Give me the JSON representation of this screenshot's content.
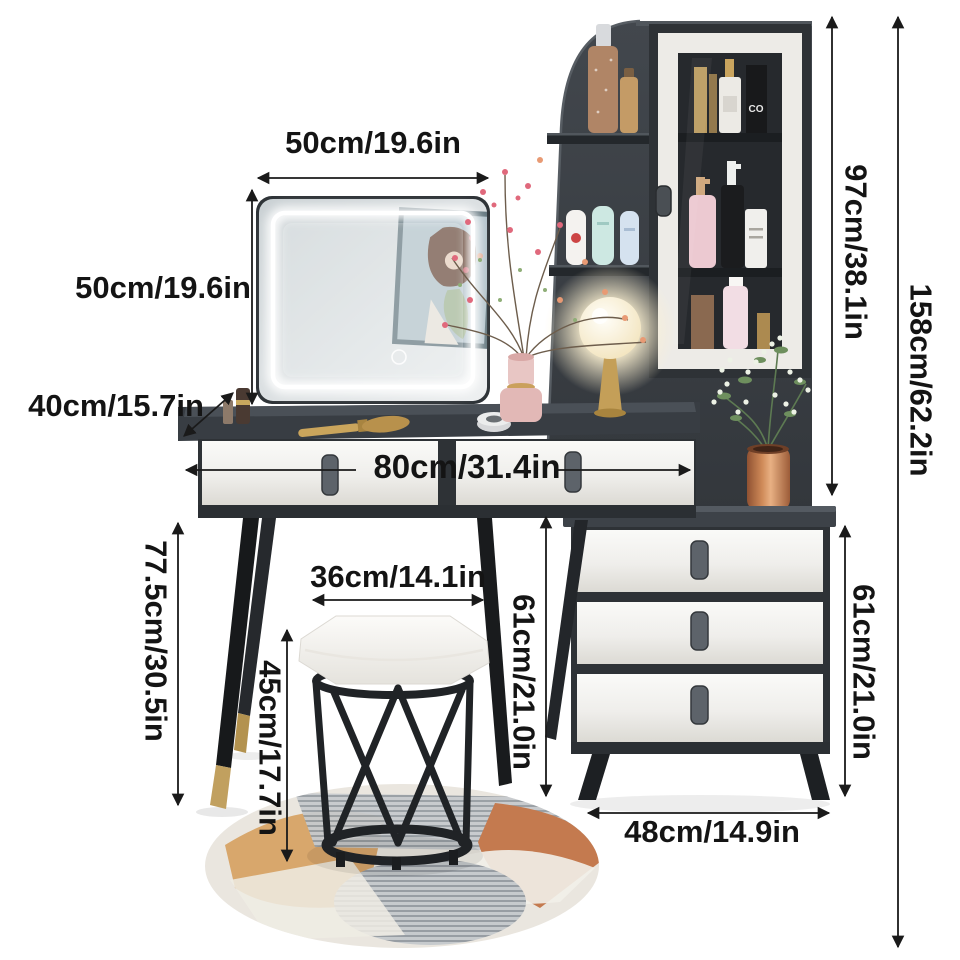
{
  "dims": {
    "mirror_width": "50cm/19.6in",
    "mirror_height": "50cm/19.6in",
    "table_depth": "40cm/15.7in",
    "table_width": "80cm/31.4in",
    "table_height": "77.5cm/30.5in",
    "stool_width": "36cm/14.1in",
    "stool_height": "45cm/17.7in",
    "side_cabinet_height": "61cm/21.0in",
    "side_cabinet_height_right": "61cm/21.0in",
    "hutch_height": "97cm/38.1in",
    "total_height": "158cm/62.2in",
    "side_cabinet_width": "48cm/14.9in"
  },
  "scene": {
    "black_bottle_label": "CO"
  },
  "colors": {
    "background": "#ffffff",
    "annotation_text": "#141414",
    "charcoal_panel": "#3a3f45",
    "drawer_white": "#f0efec",
    "leg_black": "#1d2022",
    "gold_accent": "#c3a05e",
    "copper_vase": "#b5714a",
    "blush_pink_vase": "#e6c2c0",
    "rug_tan": "#d8a76c",
    "rug_terracotta": "#c47a4f",
    "rug_ribbed_gray": "#c6cacd"
  }
}
